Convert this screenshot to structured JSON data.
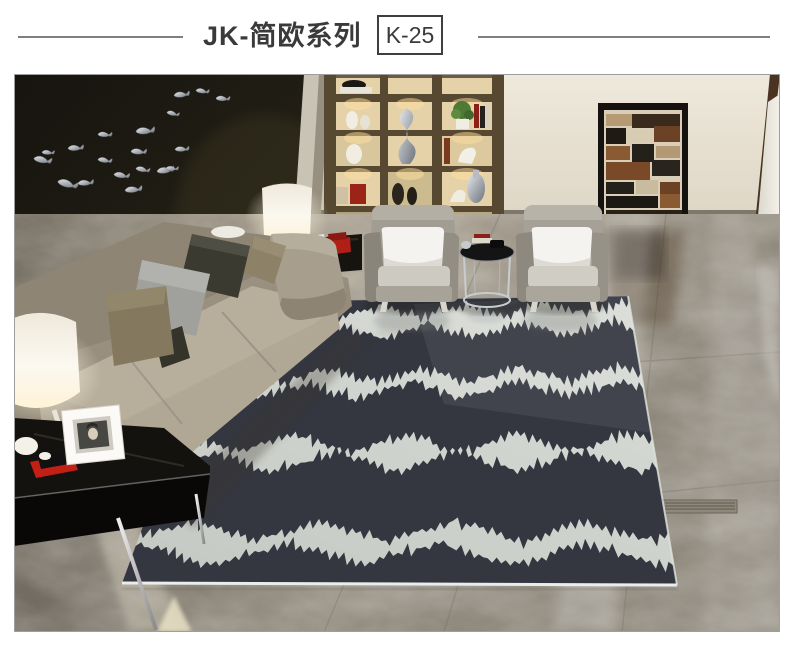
{
  "header": {
    "title": "JK-简欧系列",
    "model": "K-25",
    "text_color": "#3a3a3a",
    "rule_color": "#7f7f7f"
  },
  "photo": {
    "scene_palette": {
      "feature_wall": "#26231a",
      "cream_wall": "#e9e3d6",
      "shelf_wood": "#6a5b44",
      "rug_background": "#cfd4cf",
      "rug_pattern": "#343640",
      "sofa_fabric": "#a09786",
      "armchair_fabric": "#a29d93",
      "floor_marble": "#a89f92",
      "accent_red": "#c21f16",
      "screen_brown": "#7a4a28",
      "lamp_white": "#f8f5ec",
      "fish_silver": "#b8bcc0"
    }
  }
}
